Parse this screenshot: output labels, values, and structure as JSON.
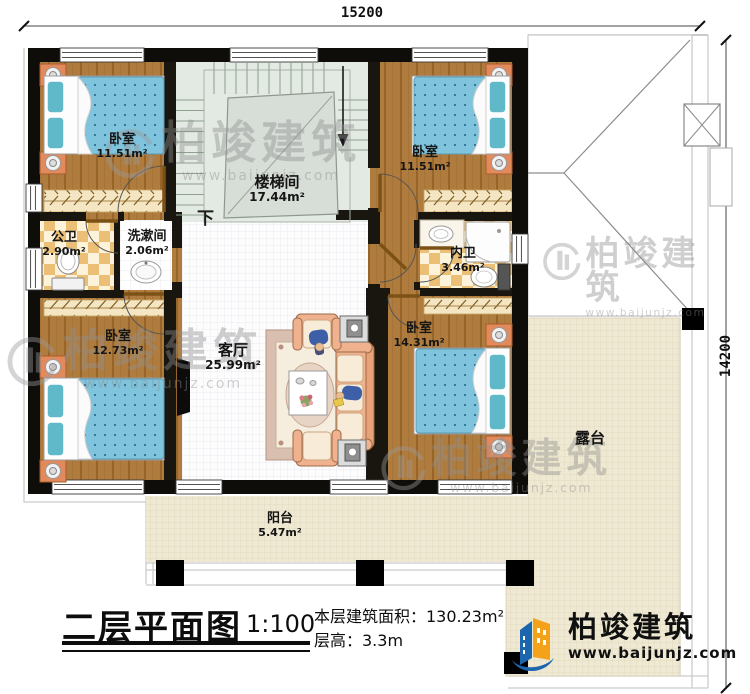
{
  "plan": {
    "dimension_top": "15200",
    "dimension_right": "14200",
    "stairs_down_label": "下",
    "rooms": {
      "bedroom_tl": {
        "name": "卧室",
        "area": "11.51m²"
      },
      "stairwell": {
        "name": "楼梯间",
        "area": "17.44m²"
      },
      "bedroom_tr": {
        "name": "卧室",
        "area": "11.51m²"
      },
      "public_bath": {
        "name": "公卫",
        "area": "2.90m²"
      },
      "washroom": {
        "name": "洗漱间",
        "area": "2.06m²"
      },
      "ensuite_bath": {
        "name": "内卫",
        "area": "3.46m²"
      },
      "bedroom_bl": {
        "name": "卧室",
        "area": "12.73m²"
      },
      "living_room": {
        "name": "客厅",
        "area": "25.99m²"
      },
      "bedroom_br": {
        "name": "卧室",
        "area": "14.31m²"
      },
      "balcony": {
        "name": "阳台",
        "area": "5.47m²"
      },
      "terrace": {
        "name": "露台"
      }
    }
  },
  "title_block": {
    "title": "二层平面图",
    "scale": "1:100",
    "building_area": "本层建筑面积：130.23m²",
    "floor_height": "层高：3.3m"
  },
  "watermark": {
    "brand": "柏竣建筑",
    "url": "www.baijunjz.com"
  },
  "logo": {
    "brand": "柏竣建筑",
    "url": "www.baijunjz.com"
  }
}
